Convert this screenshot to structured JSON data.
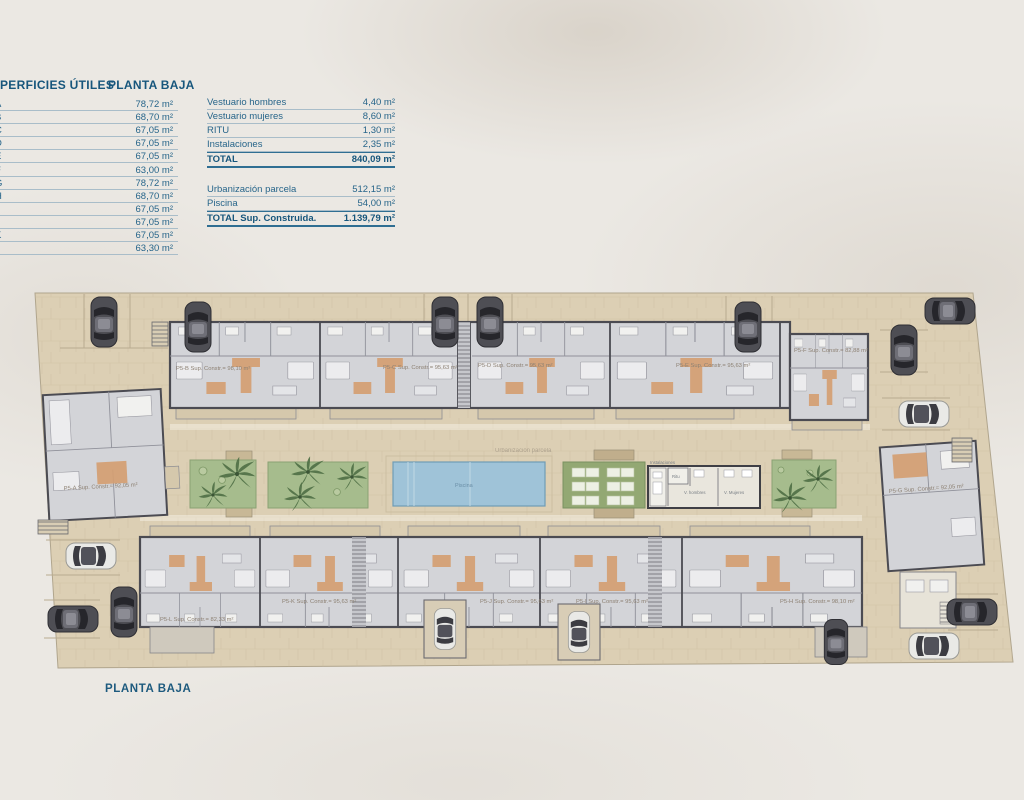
{
  "header": {
    "surfaces_title": "PERFICIES ÚTILES",
    "floor_title": "PLANTA BAJA"
  },
  "useful_surfaces_rows": [
    {
      "label": "A",
      "value": "78,72 m²"
    },
    {
      "label": "B",
      "value": "68,70 m²"
    },
    {
      "label": "C",
      "value": "67,05 m²"
    },
    {
      "label": "D",
      "value": "67,05 m²"
    },
    {
      "label": "E",
      "value": "67,05 m²"
    },
    {
      "label": "F",
      "value": "63,00 m²"
    },
    {
      "label": "G",
      "value": "78,72 m²"
    },
    {
      "label": "H",
      "value": "68,70 m²"
    },
    {
      "label": "I",
      "value": "67,05 m²"
    },
    {
      "label": "J",
      "value": "67,05 m²"
    },
    {
      "label": "K",
      "value": "67,05 m²"
    },
    {
      "label": "L",
      "value": "63,30 m²"
    }
  ],
  "summary": {
    "rows": [
      {
        "label": "Vestuario hombres",
        "value": "4,40 m²"
      },
      {
        "label": "Vestuario mujeres",
        "value": "8,60 m²"
      },
      {
        "label": "RITU",
        "value": "1,30 m²"
      },
      {
        "label": "Instalaciones",
        "value": "2,35 m²"
      }
    ],
    "total_label": "TOTAL",
    "total_value": "840,09 m²",
    "rows2": [
      {
        "label": "Urbanización parcela",
        "value": "512,15 m²"
      },
      {
        "label": "Piscina",
        "value": "54,00 m²"
      }
    ],
    "total2_label": "TOTAL Sup. Construida.",
    "total2_value": "1.139,79 m²"
  },
  "plan": {
    "unit_labels": {
      "a": "P5-A Sup. Constr.= 92,05 m²",
      "b": "P5-B Sup. Constr.= 98,10 m²",
      "c": "P5-C Sup. Constr.= 95,63 m²",
      "d": "P5-D Sup. Constr.= 95,63 m²",
      "e": "P5-E Sup. Constr.= 95,63 m²",
      "f": "P5-F Sup. Constr.= 82,88 m²",
      "g": "P5-G Sup. Constr.= 92,05 m²",
      "h": "P5-H Sup. Constr.= 98,10 m²",
      "i": "P5-I Sup. Constr.= 95,63 m²",
      "j": "P5-J Sup. Constr.= 95,63 m²",
      "k": "P5-K Sup. Constr.= 95,63 m²",
      "l": "P5-L Sup. Constr.= 82,33 m²"
    },
    "area_labels": {
      "piscina": "Piscina",
      "urbanizacion": "Urbanización parcela",
      "instalaciones": "Instalaciones",
      "ritu": "Ritu",
      "v_hombres": "V. hombres",
      "v_mujeres": "V. Mujeres"
    }
  },
  "footer": {
    "floor_label": "PLANTA BAJA"
  },
  "colors": {
    "accent_blue": "#1e5b7e",
    "paving": "#dccfb4",
    "building": "#d3d4d8",
    "wall": "#4b4b52",
    "pool": "#9fc3d8",
    "lawn": "#a6bc8d",
    "palm": "#4f6f45",
    "accent_orange": "#d49e72"
  }
}
